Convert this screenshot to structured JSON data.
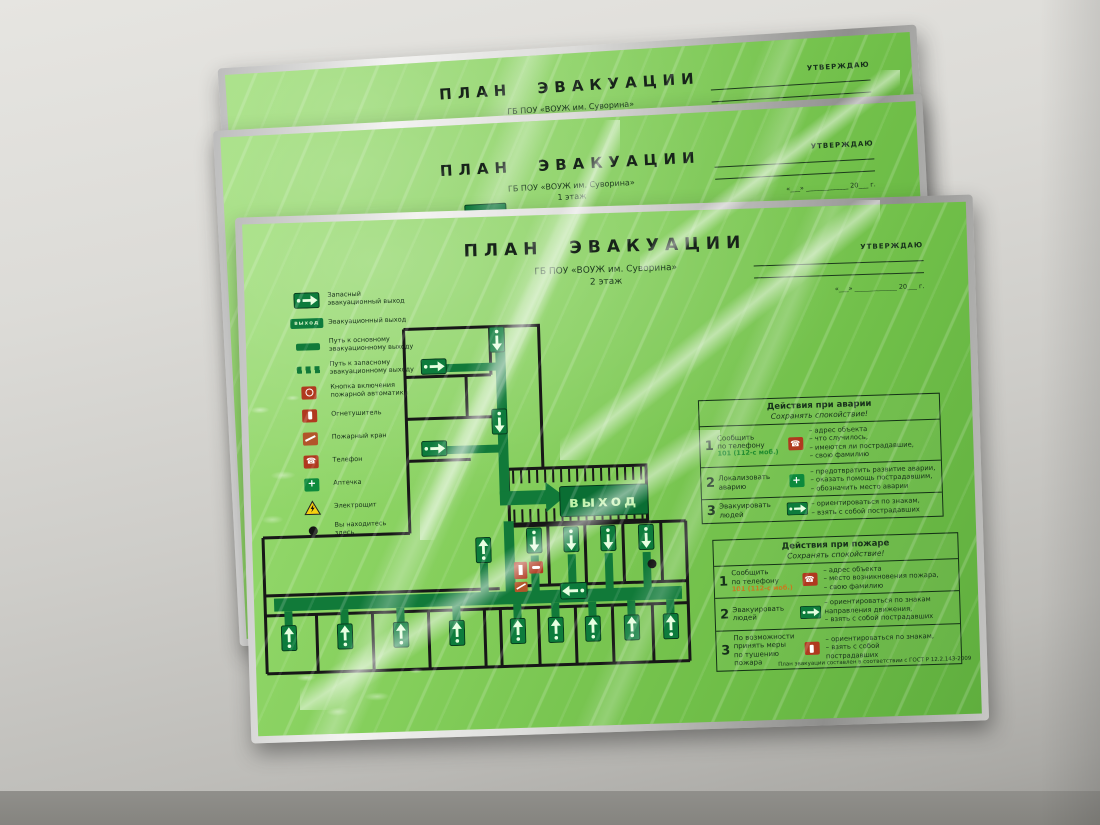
{
  "colors": {
    "plate_green": "#85cf5c",
    "route_green": "#117a39",
    "sign_green": "#0d7c3c",
    "alarm_red": "#b0391f",
    "warning_yellow": "#f6d010",
    "frame_aluminum": "#c7c7c5"
  },
  "plates": {
    "back_top": {
      "title": "ПЛАН ЭВАКУАЦИИ",
      "org": "ГБ ПОУ «ВОУЖ им. Суворина»",
      "floor": "3 этаж",
      "approve_label": "УТВЕРЖДАЮ",
      "date_line": "«___» _____________ 20___ г.",
      "stamp_text": "выход"
    },
    "middle": {
      "title": "ПЛАН ЭВАКУАЦИИ",
      "org": "ГБ ПОУ «ВОУЖ им. Суворина»",
      "floor": "1 этаж",
      "approve_label": "УТВЕРЖДАЮ",
      "date_line": "«___» _____________ 20___ г.",
      "stamp_text": "выход",
      "stamp_caption": "Запасный\nэвакуационный выход"
    },
    "front": {
      "title": "ПЛАН ЭВАКУАЦИИ",
      "org": "ГБ ПОУ «ВОУЖ им. Суворина»",
      "floor": "2 этаж",
      "approve_label": "УТВЕРЖДАЮ",
      "date_line": "«___» _____________ 20___ г.",
      "exit_big_text": "выход",
      "exit_word": "выход",
      "legend": [
        {
          "icon": "emergency-exit-sign",
          "label": "Запасный\nэвакуационный выход"
        },
        {
          "icon": "exit-sign",
          "label": "Эвакуационный выход"
        },
        {
          "icon": "main-route-bar",
          "label": "Путь к основному\nэвакуационному выходу"
        },
        {
          "icon": "reserve-route-bar",
          "label": "Путь к запасному\nэвакуационному выходу"
        },
        {
          "icon": "fire-alarm-button",
          "label": "Кнопка включения\nпожарной автоматики"
        },
        {
          "icon": "fire-extinguisher",
          "label": "Огнетушитель"
        },
        {
          "icon": "fire-hydrant",
          "label": "Пожарный кран"
        },
        {
          "icon": "phone",
          "label": "Телефон"
        },
        {
          "icon": "first-aid-kit",
          "label": "Аптечка"
        },
        {
          "icon": "electric-panel",
          "label": "Электрощит"
        },
        {
          "icon": "you-are-here",
          "label": "Вы находитесь\nздесь"
        }
      ],
      "tables": [
        {
          "title": "Действия при аварии",
          "subtitle": "Сохранять спокойствие!",
          "rows": [
            {
              "num": "1",
              "action": "Сообщить\nпо телефону",
              "phone": "101 (112-с моб.)",
              "icon": "phone",
              "points": "– адрес объекта\n– что случилось,\n– имеются ли пострадавшие,\n– свою фамилию"
            },
            {
              "num": "2",
              "action": "Локализовать\nаварию",
              "icon": "medical-cross",
              "points": "– предотвратить развитие аварии,\n– оказать помощь пострадавшим,\n– обозначить место аварии"
            },
            {
              "num": "3",
              "action": "Эвакуировать\nлюдей",
              "icon": "exit-running",
              "points": "– ориентироваться по знакам,\n– взять с собой пострадавших"
            }
          ]
        },
        {
          "title": "Действия при пожаре",
          "subtitle": "Сохранять спокойствие!",
          "rows": [
            {
              "num": "1",
              "action": "Сообщить\nпо телефону",
              "phone": "101 (112-с моб.)",
              "icon": "phone",
              "points": "– адрес объекта\n– место возникновения пожара,\n– свою фамилию"
            },
            {
              "num": "2",
              "action": "Эвакуировать\nлюдей",
              "icon": "exit-running",
              "points": "– ориентироваться по знакам\nнаправления движения,\n– взять с собой пострадавших"
            },
            {
              "num": "3",
              "action": "По возможности\nпринять меры\nпо тушению пожара",
              "icon": "fire-extinguisher",
              "points": "– ориентироваться по знакам,\n– взять с собой\nпострадавших"
            }
          ]
        }
      ],
      "footer": "План эвакуации составлен в соответствии с ГОСТ Р 12.2.143-2009"
    }
  }
}
